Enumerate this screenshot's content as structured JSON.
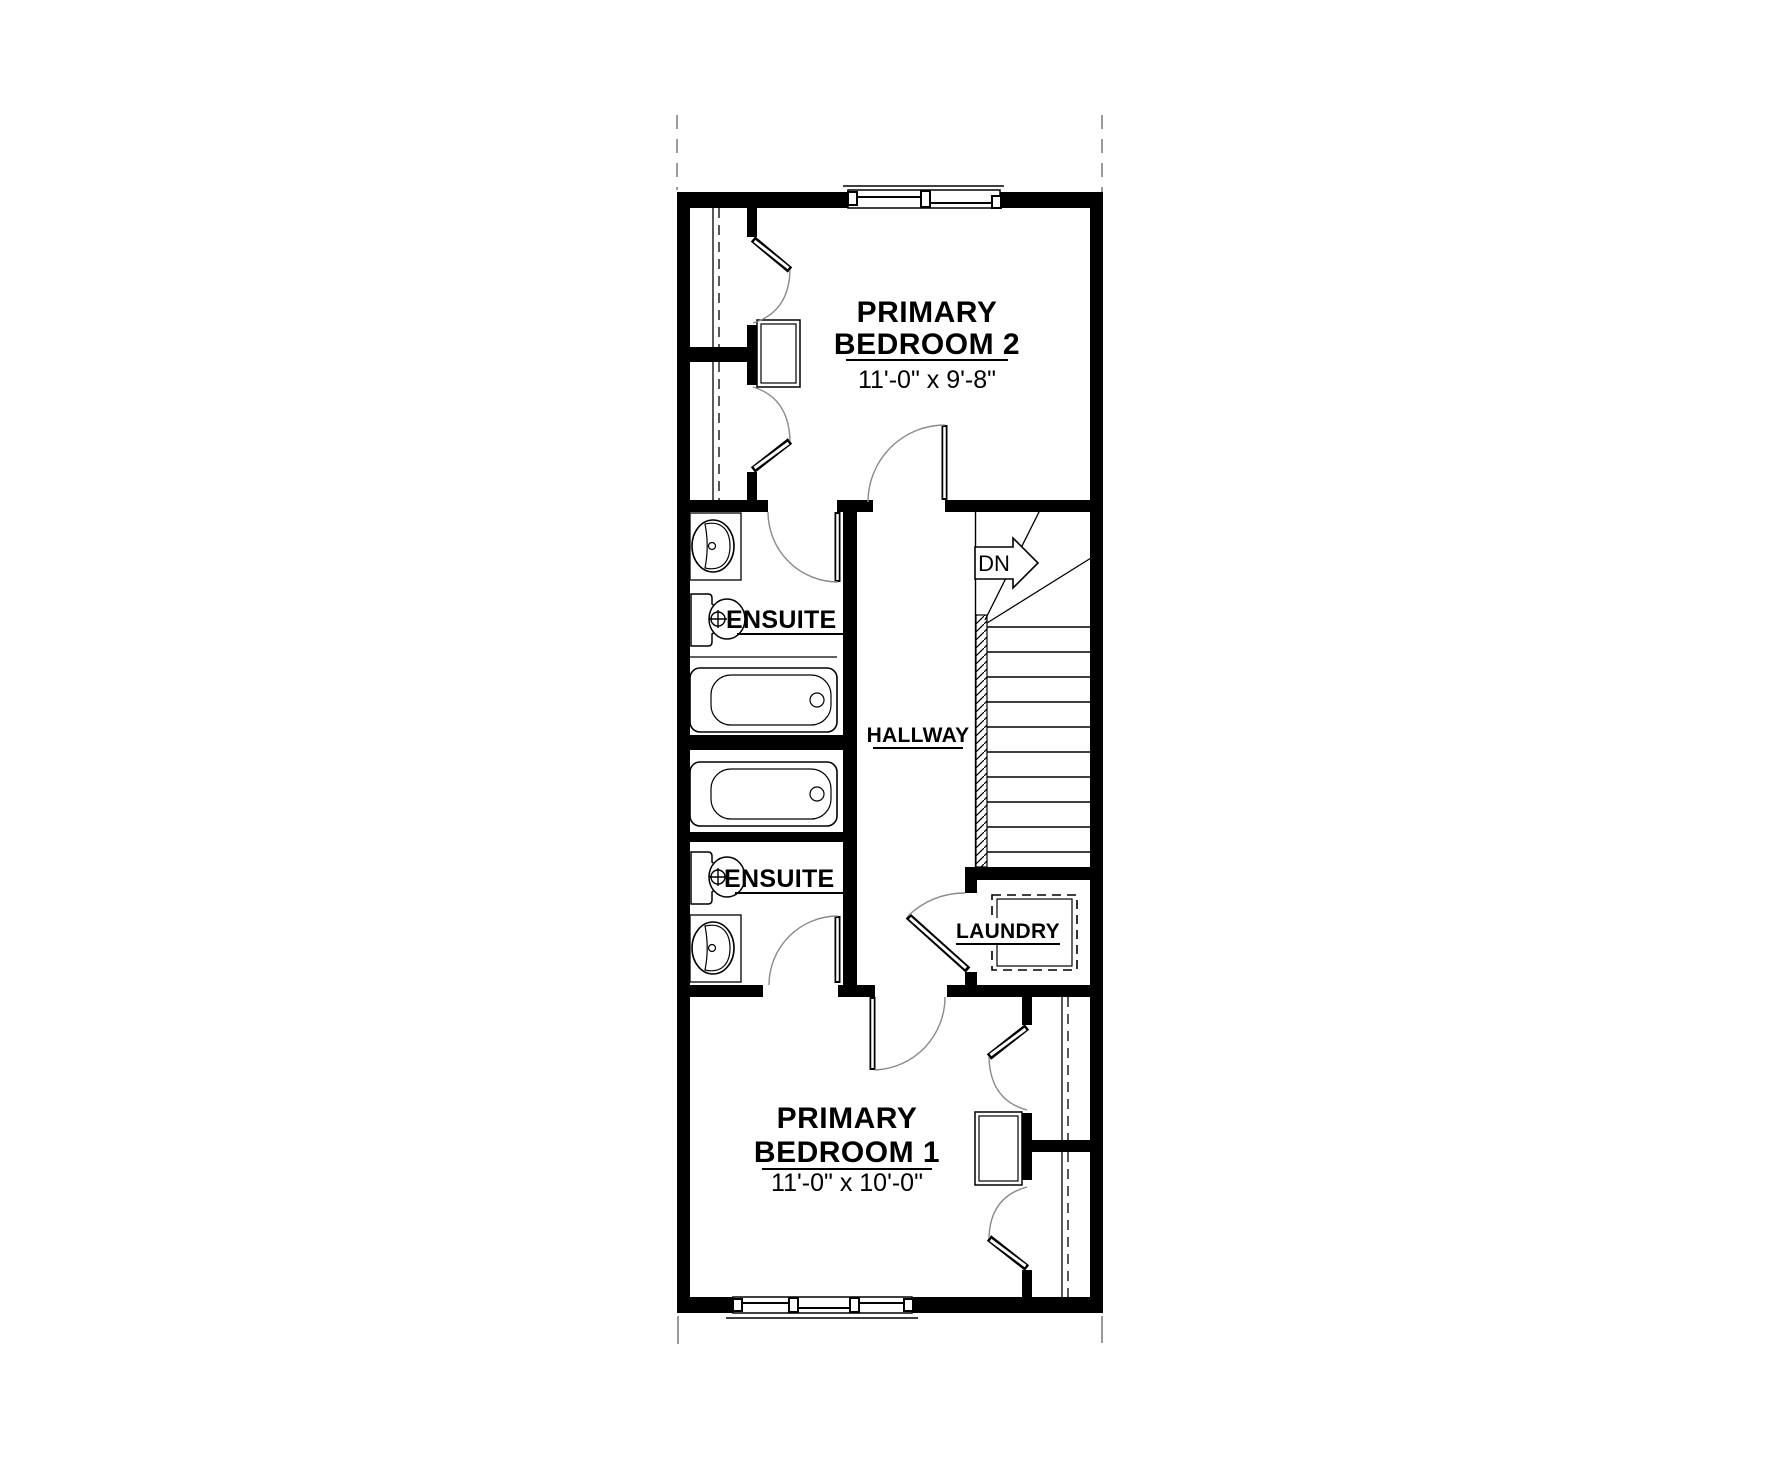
{
  "drawing": {
    "type": "floor-plan",
    "floor": "upper"
  },
  "rooms": {
    "bedroom2": {
      "line1": "PRIMARY",
      "line2": "BEDROOM 2",
      "dims": "11'-0\" x 9'-8\""
    },
    "bedroom1": {
      "line1": "PRIMARY",
      "line2": "BEDROOM 1",
      "dims": "11'-0\" x 10'-0\""
    },
    "ensuite2": {
      "label": "ENSUITE 2"
    },
    "ensuite1": {
      "label": "ENSUITE 1"
    },
    "hallway": {
      "label": "HALLWAY"
    },
    "laundry": {
      "label": "LAUNDRY"
    },
    "stairs": {
      "label": "DN"
    }
  },
  "colors": {
    "wall": "#000000",
    "thin_line": "#000000",
    "door_arc": "#8a8a8a",
    "reference_line": "#9a9a9a",
    "background": "#ffffff"
  }
}
